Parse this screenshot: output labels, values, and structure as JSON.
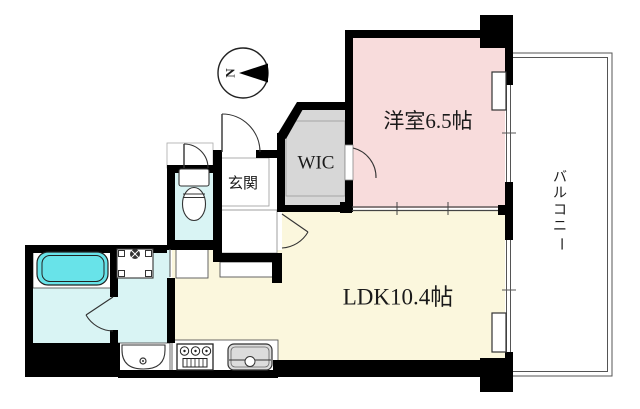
{
  "compass": {
    "label": "N"
  },
  "rooms": {
    "bedroom": {
      "label": "洋室6.5帖"
    },
    "ldk": {
      "label": "LDK10.4帖"
    },
    "wic": {
      "label": "WIC"
    },
    "entrance": {
      "label": "玄関"
    },
    "balcony": {
      "label": "バルコニー",
      "chars": [
        "バ",
        "ル",
        "コ",
        "ニ",
        "ー"
      ]
    }
  },
  "colors": {
    "bedroom": "#f8dcdc",
    "ldk": "#fbf7dd",
    "wet_room": "#d9f4f4",
    "bathtub": "#68e3e9",
    "wic": "#d7d7d7",
    "wall": "#000000",
    "sink": "#dcdcdc"
  }
}
